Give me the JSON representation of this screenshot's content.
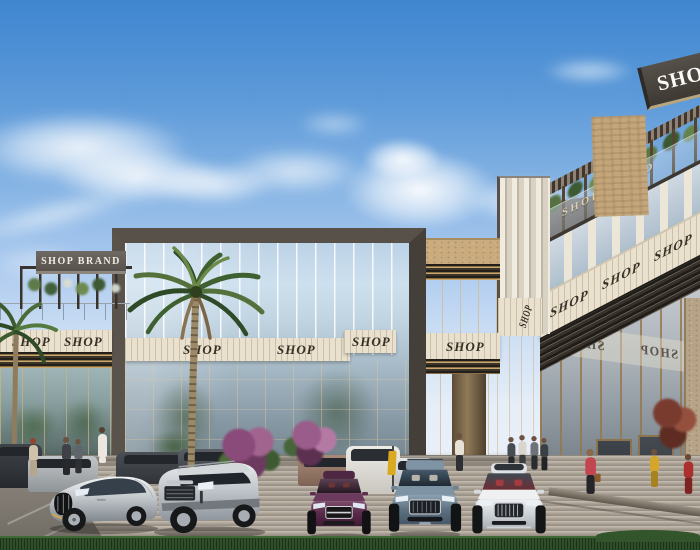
{
  "scene": {
    "title": "Retail plaza exterior render",
    "setting": "Modern two-story shopping strip with glass facades, rooftop pergolas, palm trees and luxury cars parked in front"
  },
  "signs": {
    "left_brand": "SHOP BRAND",
    "top_right_sign": "SHOP",
    "right_parapet_brand": "SHOP BRAND",
    "left_fascia": [
      "SHOP",
      "SHOP"
    ],
    "atrium_fascia": [
      "SHOP",
      "SHOP",
      "SHOP"
    ],
    "mid_fascia": "SHOP",
    "corner_fascia": "SHOP",
    "right_fascia": [
      "SHOP",
      "SHOP",
      "SHOP"
    ],
    "glass_reflections": [
      "SHOP",
      "SHOP"
    ]
  },
  "palette": {
    "sky_top": "#3f86d0",
    "sky_horizon": "#eef2f7",
    "cloud": "#ffffff",
    "frame_dark": "#57504a",
    "fascia_cream": "#e9e1cd",
    "sign_text": "#362f26",
    "bronze_louver": "#caa76b",
    "glass_blue": "#bcd2e6",
    "stone_tan": "#c4a67a",
    "pavement": "#b1a89c",
    "grass": "#2e4d28",
    "car_silver": "#c9cdd1",
    "car_white": "#eef0f1",
    "car_purple": "#5f2c4e",
    "car_blue_gray": "#8fa3b5"
  }
}
